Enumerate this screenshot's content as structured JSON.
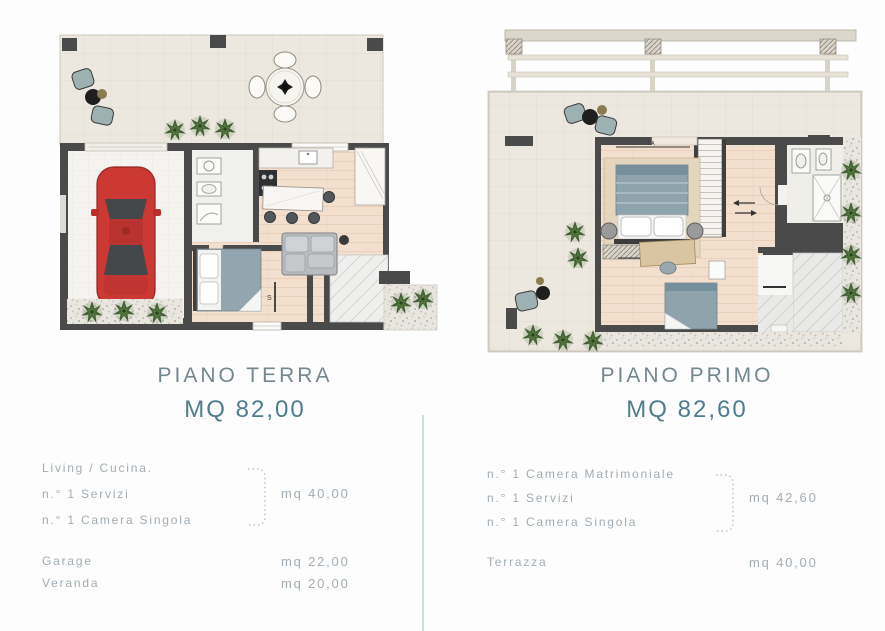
{
  "colors": {
    "background": "#fdfdfd",
    "title_text": "#73878f",
    "area_accent": "#4e7d8b",
    "body_text": "#a2adb3",
    "bracket": "#b7c6cb",
    "divider": "#cbdeda",
    "wall": "#4a4a4a",
    "tile_floor": "#ece8df",
    "wood_floor": "#f3dfcd",
    "car_red": "#cc3934",
    "plant_green": "#3f5d32",
    "outdoor_chair_teal": "#9db0b2"
  },
  "left_unit": {
    "title": "PIANO TERRA",
    "area": "MQ 82,00",
    "grouped_rooms": [
      "Living / Cucina.",
      "n.° 1 Servizi",
      "n.° 1 Camera Singola"
    ],
    "grouped_area": "mq 40,00",
    "extras": [
      {
        "label": "Garage",
        "area": "mq 22,00"
      },
      {
        "label": "Veranda",
        "area": "mq 20,00"
      }
    ],
    "plan_marks": {
      "stairs": "S"
    }
  },
  "right_unit": {
    "title": "PIANO PRIMO",
    "area": "MQ 82,60",
    "grouped_rooms": [
      "n.° 1 Camera Matrimoniale",
      "n.° 1 Servizi",
      "n.° 1 Camera Singola"
    ],
    "grouped_area": "mq 42,60",
    "extras": [
      {
        "label": "Terrazza",
        "area": "mq 40,00"
      }
    ],
    "plan_marks": {
      "bed_dim_top": "LA",
      "bed_dim_bottom": "LA"
    }
  }
}
